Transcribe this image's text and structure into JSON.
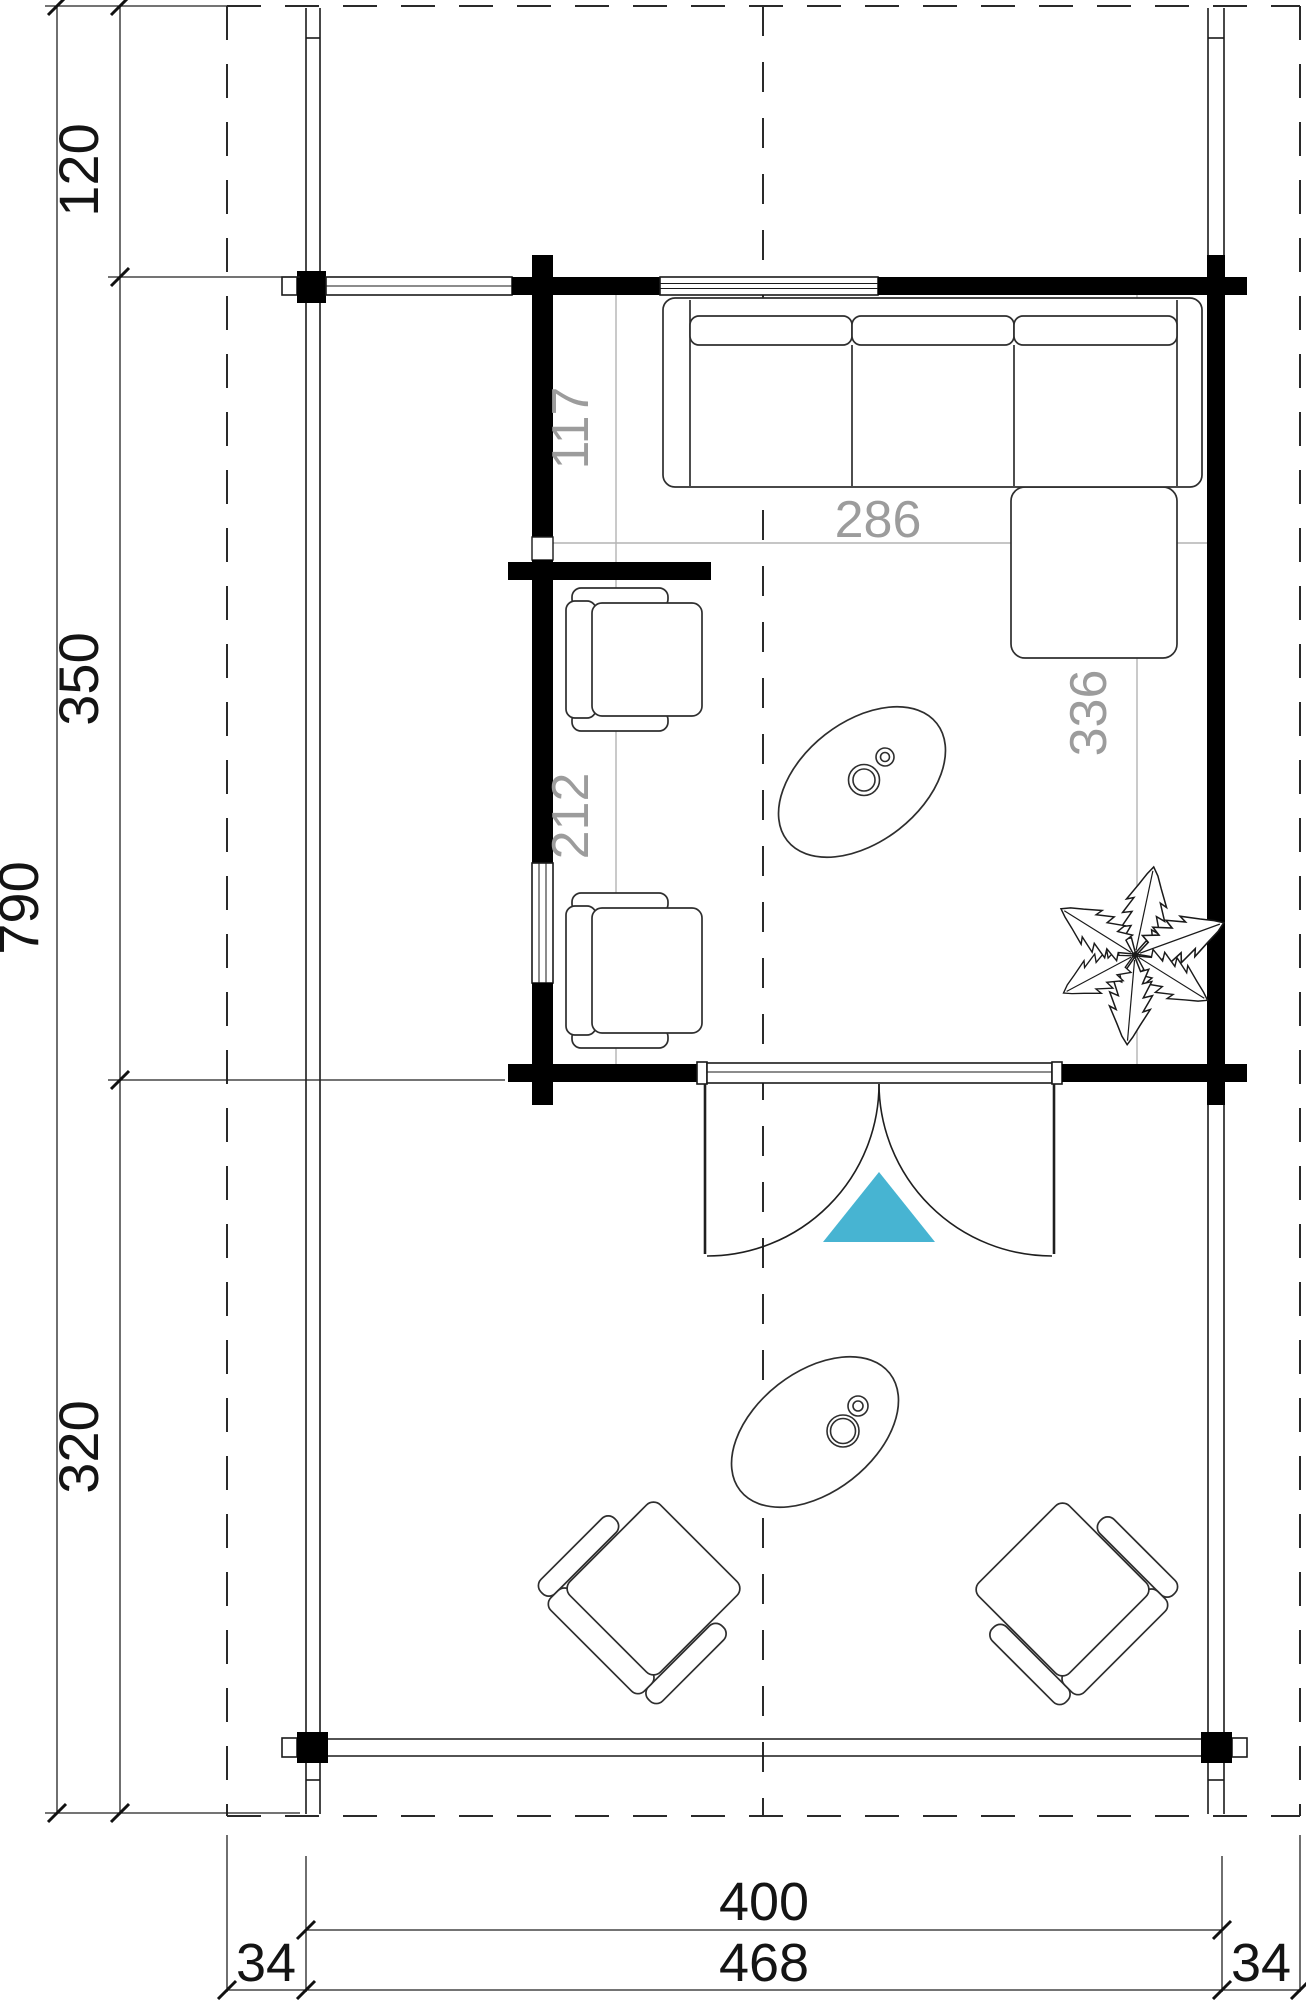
{
  "plan": {
    "title_semantic": "log-cabin-with-terrace-floor-plan",
    "accent_color": "#47b4d2",
    "dims_outer": {
      "overall_depth": "790",
      "roof_overhang_top": "120",
      "cabin_depth": "350",
      "terrace_depth": "320",
      "cabin_width": "400",
      "overall_width": "468",
      "margin_left": "34",
      "margin_right": "34"
    },
    "dims_inner": {
      "alcove_depth": "117",
      "lower_wall_length": "212",
      "room_width": "286",
      "room_depth": "336"
    },
    "legend": {
      "door_marker": "entrance-marker-triangle",
      "plant": "potted-plant",
      "sofa": "corner-sofa-with-chaise",
      "tables": "oval-coffee-tables",
      "chairs": "armchairs"
    }
  }
}
